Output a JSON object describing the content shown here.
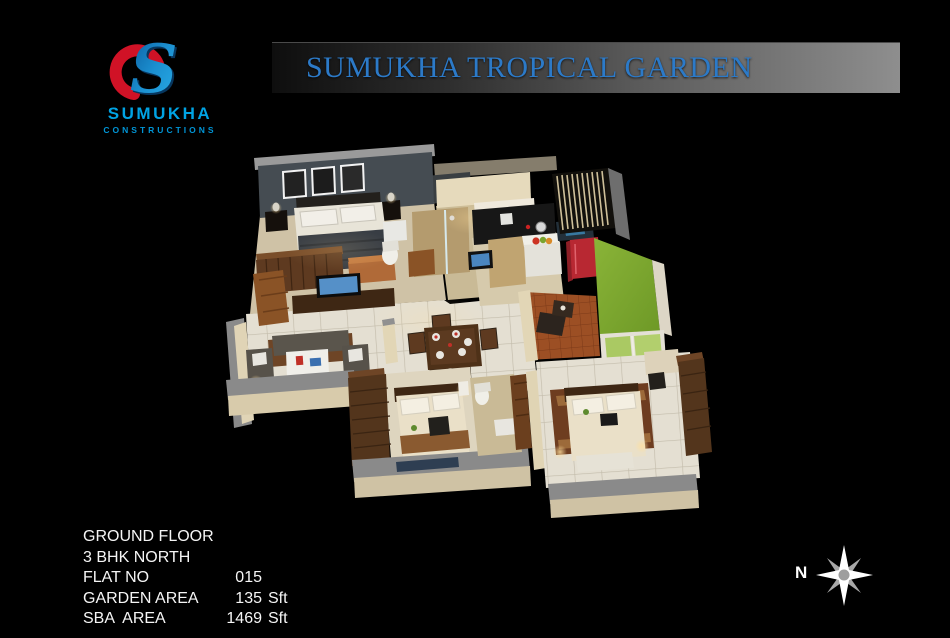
{
  "banner": {
    "title": "SUMUKHA TROPICAL GARDEN",
    "text_color": "#2c7ac8"
  },
  "logo": {
    "name": "SUMUKHA",
    "subtitle": "CONSTRUCTIONS",
    "blue": "#00a3e3",
    "red": "#d01226"
  },
  "specs": {
    "rows": [
      {
        "label": "GROUND FLOOR",
        "value": "",
        "unit": ""
      },
      {
        "label": "3 BHK NORTH",
        "value": "",
        "unit": ""
      },
      {
        "label": "FLAT NO",
        "value": "015",
        "unit": ""
      },
      {
        "label": "GARDEN AREA",
        "value": "135",
        "unit": "Sft"
      },
      {
        "label": "SBA  AREA",
        "value": "1469",
        "unit": "Sft"
      }
    ]
  },
  "compass": {
    "label": "N"
  },
  "colors": {
    "background": "#000000",
    "banner_gradient_start": "#0e0e0e",
    "banner_gradient_end": "#8e8e8e",
    "title_blue": "#2c7ac8",
    "garden_green": "#7aa32c",
    "fridge_red": "#b82832",
    "accent_wall_gray": "#454c52",
    "wood_brown": "#5e3a20",
    "wall_cream": "#e2d6b6"
  }
}
